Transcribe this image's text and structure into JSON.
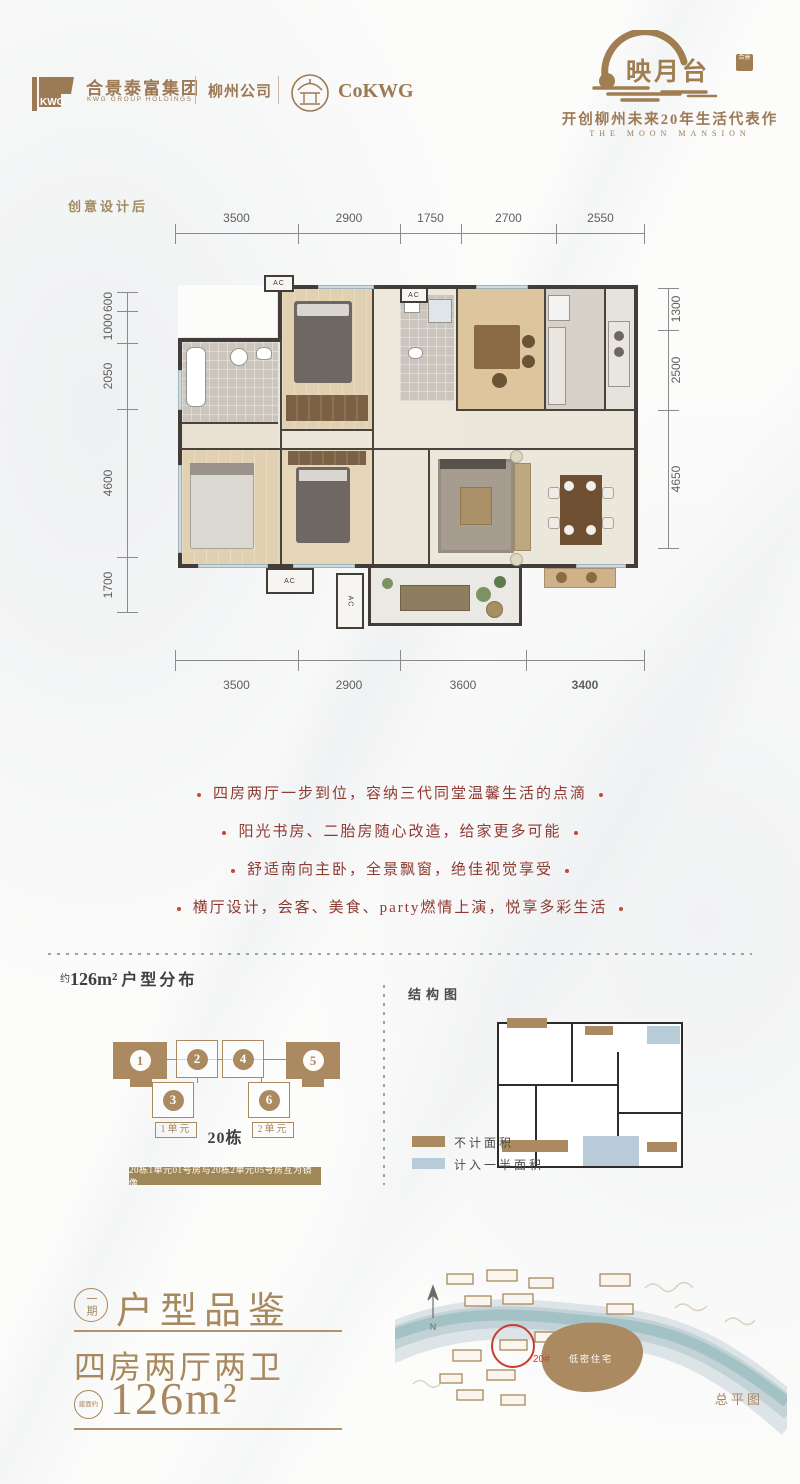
{
  "header": {
    "kwg_logo_text": "KWG",
    "group_name": "合景泰富集团",
    "group_name_en": "KWG GROUP HOLDINGS",
    "company": "柳州公司",
    "cokwg": "CoKWG",
    "brand_name": "映月台",
    "brand_seal": "合景",
    "tagline": "开创柳州未来20年生活代表作",
    "tagline_en": "THE MOON MANSION"
  },
  "floorplan": {
    "corner_label": "创意设计后",
    "ac_label": "AC",
    "dims_top": [
      "3500",
      "2900",
      "1750",
      "2700",
      "2550"
    ],
    "dims_bottom": [
      "3500",
      "2900",
      "3600",
      "3400"
    ],
    "dims_left": [
      "600",
      "1000",
      "2050",
      "4600",
      "1700"
    ],
    "dims_right": [
      "1300",
      "2500",
      "4650"
    ]
  },
  "features": [
    "四房两厅一步到位，容纳三代同堂温馨生活的点滴",
    "阳光书房、二胎房随心改造，给家更多可能",
    "舒适南向主卧，全景飘窗，绝佳视觉享受",
    "横厅设计，会客、美食、party燃情上演，悦享多彩生活"
  ],
  "distribution": {
    "title_prefix": "约",
    "title_area": "126m²",
    "title_suffix": "户型分布",
    "units": [
      {
        "num": "1"
      },
      {
        "num": "2"
      },
      {
        "num": "3"
      },
      {
        "num": "4"
      },
      {
        "num": "5"
      },
      {
        "num": "6"
      }
    ],
    "unit1_label": "1单元",
    "building_label": "20栋",
    "unit2_label": "2单元",
    "mirror_note": "20栋1单元01号房与20栋2单元05号房互为镜像"
  },
  "structure": {
    "title": "结构图",
    "legend_excluded": "不计面积",
    "legend_half": "计入一半面积"
  },
  "summary": {
    "phase": "一期",
    "title": "户型品鉴",
    "layout": "四房两厅两卫",
    "area_prefix": "建面约",
    "area": "126m²"
  },
  "siteplan": {
    "north_label": "N",
    "building_tag": "20#",
    "zone_label": "低密住宅",
    "caption": "总平图"
  },
  "colors": {
    "brand_tan": "#a2805a",
    "accent_red": "#9c4036",
    "wall_dark": "#3c3734",
    "half_area_blue": "#b7ccd8"
  }
}
